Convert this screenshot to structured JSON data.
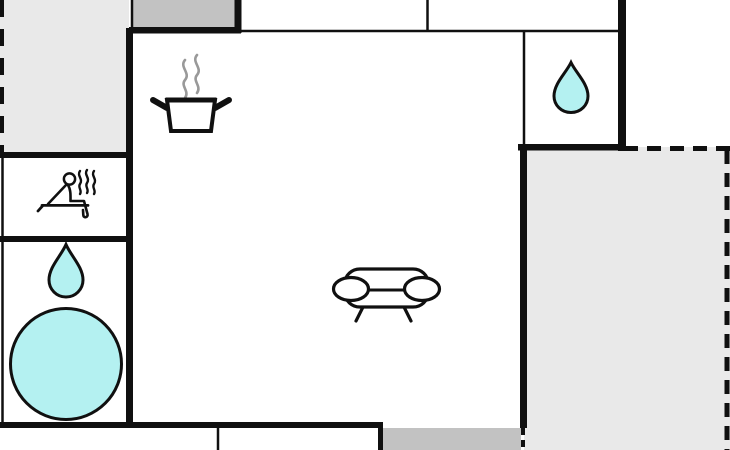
{
  "app": {
    "type": "floor-plan",
    "view": "2d-top-down"
  },
  "colors": {
    "wall": "#101010",
    "background": "#ffffff",
    "water": "#b4f1f1",
    "terrace_light": "#e9e9e9",
    "terrace_dark": "#c2c2c2",
    "steam_gray": "#999999",
    "room_fill": "#ffffff"
  },
  "rooms": [
    {
      "id": "kitchen-living-room",
      "icons": [
        "cooking-pot-icon",
        "sofa-icon"
      ]
    },
    {
      "id": "sauna-room",
      "icons": [
        "sauna-person-icon"
      ]
    },
    {
      "id": "bathroom",
      "icons": [
        "water-drop-icon",
        "round-tub-icon"
      ]
    },
    {
      "id": "shower-room",
      "icons": [
        "water-drop-icon"
      ]
    },
    {
      "id": "terrace-top-left",
      "fill": "terrace_light",
      "border": "dashed-left"
    },
    {
      "id": "terrace-right",
      "fill": "terrace_light",
      "border": "dashed-top-right"
    },
    {
      "id": "balcony-top",
      "fill": "terrace_dark"
    },
    {
      "id": "balcony-bottom",
      "fill": "terrace_dark"
    }
  ],
  "icon_legend": {
    "cooking-pot-icon": "kitchen / cooking area",
    "sofa-icon": "living area seating",
    "sauna-person-icon": "sauna",
    "water-drop-icon": "water / shower point",
    "round-tub-icon": "hot tub"
  }
}
